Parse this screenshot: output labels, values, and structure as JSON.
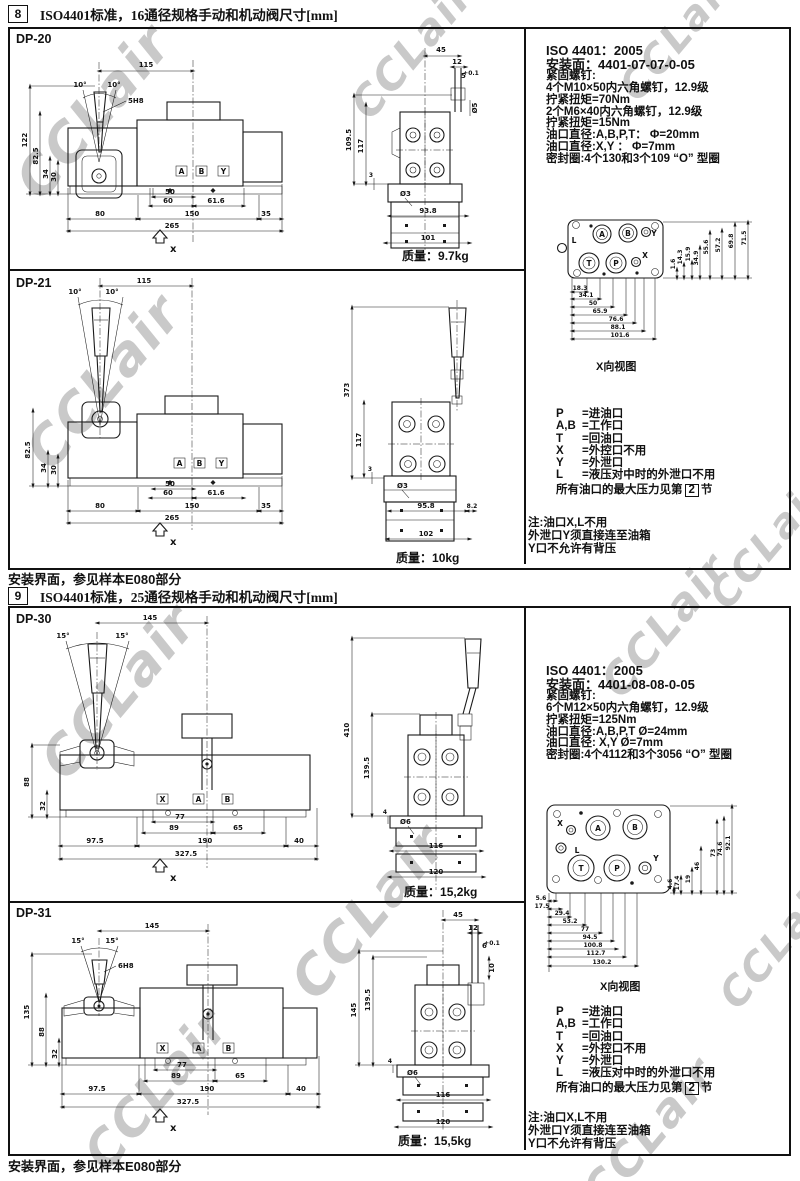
{
  "page": {
    "watermark": "CCLair",
    "footer8": "安装界面，参见样本E080部分",
    "footer9": "安装界面，参见样本E080部分"
  },
  "sec8": {
    "num": "8",
    "title": "ISO4401标准，16通径规格手动和机动阀尺寸[mm]",
    "specs": [
      "ISO 4401：2005",
      "安装面：4401-07-07-0-05",
      "紧固螺钉:",
      "4个M10×50内六角螺钉，12.9级",
      "拧紧扭矩=70Nm",
      "2个M6×40内六角螺钉，12.9级",
      "拧紧扭矩=15Nm",
      "油口直径:A,B,P,T： Φ=20mm",
      "油口直径:X,Y ： Φ=7mm",
      "密封圈:4个130和3个109 “O” 型圈"
    ],
    "legend": {
      "rows": [
        {
          "k": "P",
          "v": "=进油口"
        },
        {
          "k": "A,B",
          "v": "=工作口"
        },
        {
          "k": "T",
          "v": "=回油口"
        },
        {
          "k": "X",
          "v": "=外控口不用"
        },
        {
          "k": "Y",
          "v": "=外泄口"
        },
        {
          "k": "L",
          "v": "=液压对中时的外泄口不用"
        }
      ],
      "max_pre": "所有油口的最大压力见第",
      "max_num": "2",
      "max_post": "节"
    },
    "note": [
      "注:油口X,L不用",
      "外泄口Y须直接连至油箱",
      "Y口不允许有背压"
    ],
    "face": {
      "caption": "X向视图",
      "ports": {
        "L": "L",
        "A": "A",
        "B": "B",
        "Y": "Y",
        "T": "T",
        "P": "P",
        "X": "X"
      },
      "h": [
        "18.3",
        "34.1",
        "50",
        "65.9",
        "76.6",
        "88.1",
        "101.6"
      ],
      "v": [
        "1.6",
        "14.3",
        "15.9",
        "34.9",
        "55.6",
        "57.2",
        "69.8",
        "71.5"
      ]
    },
    "dp20": {
      "name": "DP-20",
      "mass_label": "质量：",
      "mass": "9.7kg",
      "front": {
        "w": "115",
        "a1": "10°",
        "a2": "10°",
        "bore": "5H8",
        "pA": "A",
        "pB": "B",
        "pY": "Y",
        "v": [
          "122",
          "82.5",
          "34",
          "30"
        ],
        "b": [
          "50",
          "60",
          "61.6",
          "80",
          "150",
          "35",
          "265"
        ],
        "xlab": "x"
      },
      "side": {
        "t": [
          "45",
          "12",
          "5",
          "Ø5"
        ],
        "tol": "+0.1",
        "v": [
          "109.5",
          "117",
          "3"
        ],
        "hole": "Ø3",
        "b": [
          "93.8",
          "101"
        ]
      }
    },
    "dp21": {
      "name": "DP-21",
      "mass_label": "质量：",
      "mass": "10kg",
      "front": {
        "w": "115",
        "a1": "10°",
        "a2": "10°",
        "pA": "A",
        "pB": "B",
        "pY": "Y",
        "v": [
          "82.5",
          "34",
          "30"
        ],
        "b": [
          "50",
          "60",
          "61.6",
          "80",
          "150",
          "35",
          "265"
        ],
        "xlab": "x"
      },
      "side": {
        "v": [
          "373",
          "117",
          "3"
        ],
        "hole": "Ø3",
        "b": [
          "95.8",
          "102"
        ],
        "r": "8.2"
      }
    }
  },
  "sec9": {
    "num": "9",
    "title": "ISO4401标准，25通径规格手动和机动阀尺寸[mm]",
    "specs": [
      "ISO 4401：2005",
      "安装面：4401-08-08-0-05",
      "紧固螺钉:",
      "6个M12×50内六角螺钉，12.9级",
      "拧紧扭矩=125Nm",
      "油口直径:A,B,P,T Ø=24mm",
      "油口直径: X,Y Ø=7mm",
      "密封圈:4个4112和3个3056 “O” 型圈"
    ],
    "legend": {
      "rows": [
        {
          "k": "P",
          "v": "=进油口"
        },
        {
          "k": "A,B",
          "v": "=工作口"
        },
        {
          "k": "T",
          "v": "=回油口"
        },
        {
          "k": "X",
          "v": "=外控口不用"
        },
        {
          "k": "Y",
          "v": "=外泄口"
        },
        {
          "k": "L",
          "v": "=液压对中时的外泄口不用"
        }
      ],
      "max_pre": "所有油口的最大压力见第",
      "max_num": "2",
      "max_post": "节"
    },
    "note": [
      "注:油口X,L不用",
      "外泄口Y须直接连至油箱",
      "Y口不允许有背压"
    ],
    "face": {
      "caption": "X向视图",
      "ports": {
        "X": "X",
        "A": "A",
        "B": "B",
        "L": "L",
        "T": "T",
        "P": "P",
        "Y": "Y"
      },
      "h": [
        "5.6",
        "17.5",
        "29.4",
        "53.2",
        "77",
        "94.5",
        "100.8",
        "112.7",
        "130.2"
      ],
      "v": [
        "4.6",
        "17.4",
        "19",
        "46",
        "73",
        "74.6",
        "92.1"
      ]
    },
    "dp30": {
      "name": "DP-30",
      "mass_label": "质量：",
      "mass": "15,2kg",
      "front": {
        "w": "145",
        "a1": "15°",
        "a2": "15°",
        "pX": "X",
        "pA": "A",
        "pB": "B",
        "v": [
          "88",
          "32"
        ],
        "b": [
          "77",
          "89",
          "65",
          "97.5",
          "190",
          "40",
          "327.5"
        ],
        "xlab": "x"
      },
      "side": {
        "v": [
          "410",
          "139.5",
          "4"
        ],
        "hole": "Ø6",
        "b": [
          "116",
          "120"
        ]
      }
    },
    "dp31": {
      "name": "DP-31",
      "mass_label": "质量：",
      "mass": "15,5kg",
      "front": {
        "w": "145",
        "a1": "15°",
        "a2": "15°",
        "bore": "6H8",
        "pX": "X",
        "pA": "A",
        "pB": "B",
        "v": [
          "135",
          "88",
          "32"
        ],
        "b": [
          "77",
          "89",
          "65",
          "97.5",
          "190",
          "40",
          "327.5"
        ],
        "xlab": "x"
      },
      "side": {
        "t": [
          "45",
          "12",
          "6",
          "10"
        ],
        "tol": "+0.1",
        "v": [
          "139.5",
          "145",
          "4"
        ],
        "hole": "Ø6",
        "b": [
          "116",
          "120"
        ]
      }
    }
  }
}
